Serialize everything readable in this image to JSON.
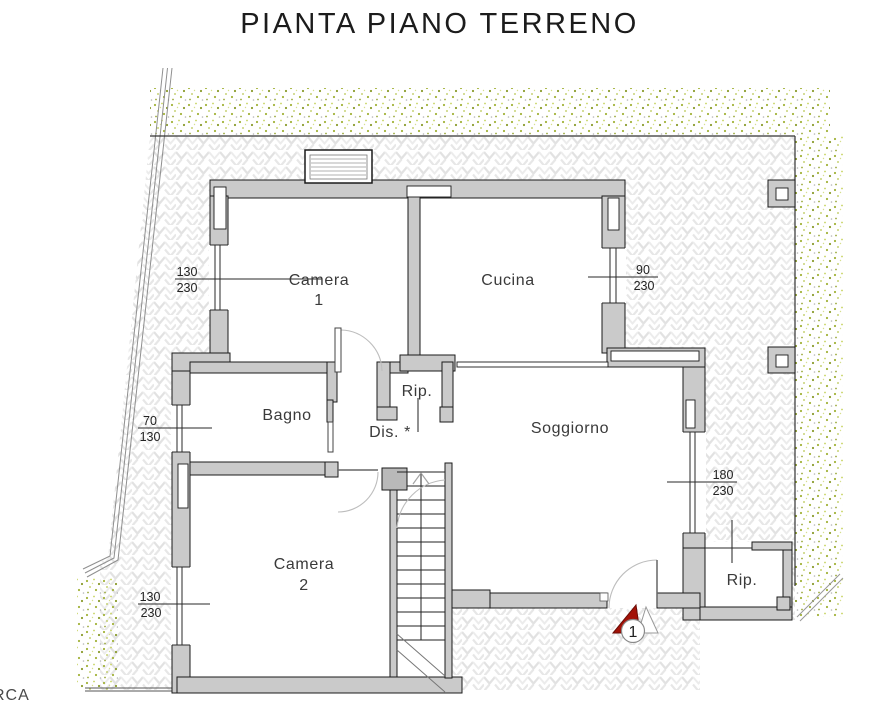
{
  "title": "PIANTA PIANO TERRENO",
  "brand_mark": "RCA",
  "rooms": {
    "camera1": {
      "line1": "Camera",
      "line2": "1"
    },
    "cucina": {
      "line1": "Cucina"
    },
    "bagno": {
      "line1": "Bagno"
    },
    "disimpegno": {
      "line1": "Dis. *"
    },
    "rip_nord": {
      "line1": "Rip."
    },
    "soggiorno": {
      "line1": "Soggiorno"
    },
    "camera2": {
      "line1": "Camera",
      "line2": "2"
    },
    "rip_sud": {
      "line1": "Rip."
    }
  },
  "window_dimensions": {
    "camera1": {
      "width": "130",
      "height": "230"
    },
    "cucina": {
      "width": "90",
      "height": "230"
    },
    "bagno": {
      "width": "70",
      "height": "130"
    },
    "soggiorno": {
      "width": "180",
      "height": "230"
    },
    "camera2": {
      "width": "130",
      "height": "230"
    }
  },
  "entrance": {
    "number": "1"
  },
  "colors": {
    "wall_fill": "#cacaca",
    "outline": "#1b1b1b",
    "entrance_red": "#a31208",
    "vegetation_green": "#a3b33b",
    "paving_line": "#e0e0e0"
  }
}
